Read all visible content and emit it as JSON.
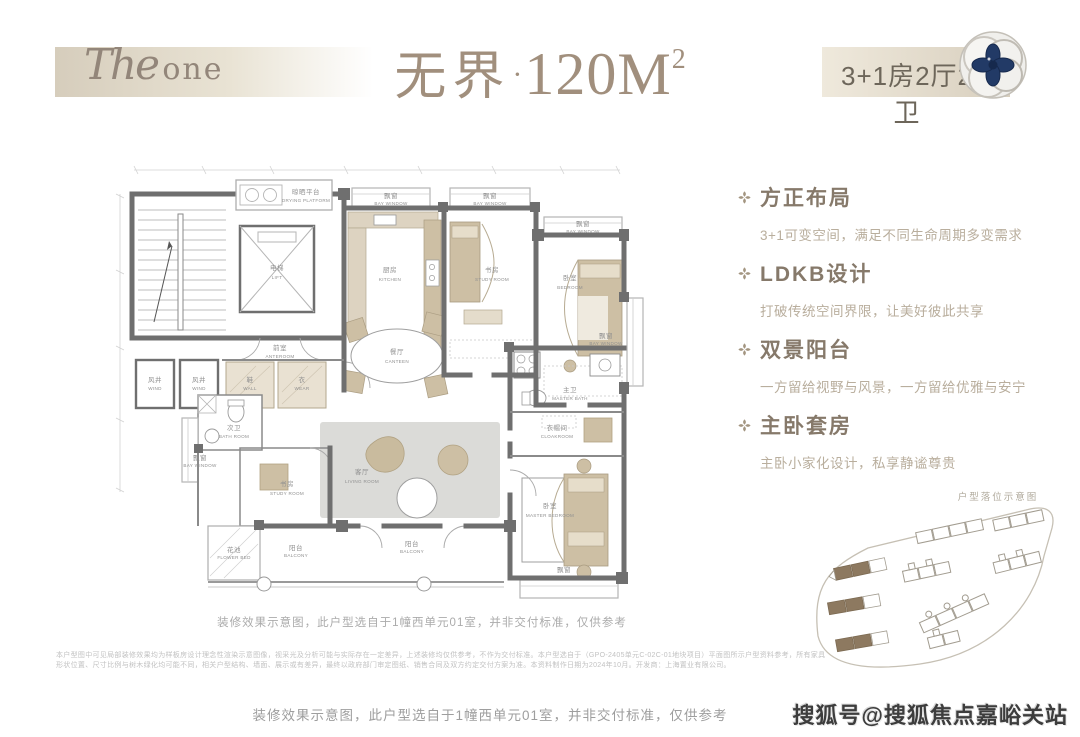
{
  "colors": {
    "band_beige": "#d6cdbc",
    "title_taupe": "#a18f7d",
    "feature_title": "#86796a",
    "feature_desc": "#b9ae9d",
    "wall_gray": "#6f6f6f",
    "furniture_tan": "#cdbfa4",
    "site_highlight": "#8d7960",
    "emblem_navy": "#223a66"
  },
  "header": {
    "brand_script": "The",
    "brand_serif": "one",
    "title_cn": "无界",
    "title_dot": "·",
    "title_num": "120M",
    "title_sup": "2",
    "unit_spec": "3+1房2厅2卫"
  },
  "features": [
    {
      "title": "方正布局",
      "desc": "3+1可变空间，满足不同生命周期多变需求"
    },
    {
      "title": "LDKB设计",
      "desc": "打破传统空间界限，让美好彼此共享"
    },
    {
      "title": "双景阳台",
      "desc": "一方留给视野与风景，一方留给优雅与安宁"
    },
    {
      "title": "主卧套房",
      "desc": "主卧小家化设计，私享静谧尊贵"
    }
  ],
  "plan": {
    "caption": "装修效果示意图，此户型选自于1幢西单元01室，并非交付标准，仅供参考",
    "labels": [
      {
        "cn": "晾晒平台",
        "en": "DRYING PLATFORM"
      },
      {
        "cn": "电梯",
        "en": "LIFT"
      },
      {
        "cn": "厨房",
        "en": "KITCHEN"
      },
      {
        "cn": "飘窗",
        "en": "BAY WINDOW"
      },
      {
        "cn": "飘窗",
        "en": "BAY WINDOW"
      },
      {
        "cn": "书房",
        "en": "STUDY ROOM"
      },
      {
        "cn": "飘窗",
        "en": "BAY WINDOW"
      },
      {
        "cn": "卧室",
        "en": "BEDROOM"
      },
      {
        "cn": "飘窗",
        "en": "BAY WINDOW"
      },
      {
        "cn": "前室",
        "en": "ANTEROOM"
      },
      {
        "cn": "风井",
        "en": "WIND"
      },
      {
        "cn": "风井",
        "en": "WIND"
      },
      {
        "cn": "鞋",
        "en": "WALL"
      },
      {
        "cn": "衣",
        "en": "WEAR"
      },
      {
        "cn": "餐厅",
        "en": "CANTEEN"
      },
      {
        "cn": "次卫",
        "en": "BATH ROOM"
      },
      {
        "cn": "飘窗",
        "en": "BAY WINDOW"
      },
      {
        "cn": "主卫",
        "en": "MASTER BATH"
      },
      {
        "cn": "衣帽间",
        "en": "CLOAKROOM"
      },
      {
        "cn": "书房",
        "en": "STUDY ROOM"
      },
      {
        "cn": "客厅",
        "en": "LIVING ROOM"
      },
      {
        "cn": "卧室",
        "en": "MASTER BEDROOM"
      },
      {
        "cn": "花池",
        "en": "FLOWER BED"
      },
      {
        "cn": "阳台",
        "en": "BALCONY"
      },
      {
        "cn": "阳台",
        "en": "BALCONY"
      },
      {
        "cn": "飘窗",
        "en": "BAY WINDOW"
      }
    ]
  },
  "siteplan": {
    "title": "户型落位示意图"
  },
  "disclaimer": {
    "line1": "本户型图中可见局部装修效果均为样板房设计理念性渲染示意图像，视采光及分析可能与实际存在一定差异，上述装修均仅供参考，不作为交付标准。本户型选自于（GPO-2405单元C-02C-01地块项目）平面图所示户型资料参考，所有家具",
    "line2": "形状位置、尺寸比例与树木绿化均可能不同，相关户型结构、墙面、展示或有差异，最终以政府部门审定图纸、销售合同及双方约定交付方案为准。本资料制作日期为2024年10月。开发商：上海置业有限公司。"
  },
  "footer": {
    "caption": "装修效果示意图，此户型选自于1幢西单元01室，并非交付标准，仅供参考",
    "watermark": "搜狐号@搜狐焦点嘉峪关站"
  }
}
